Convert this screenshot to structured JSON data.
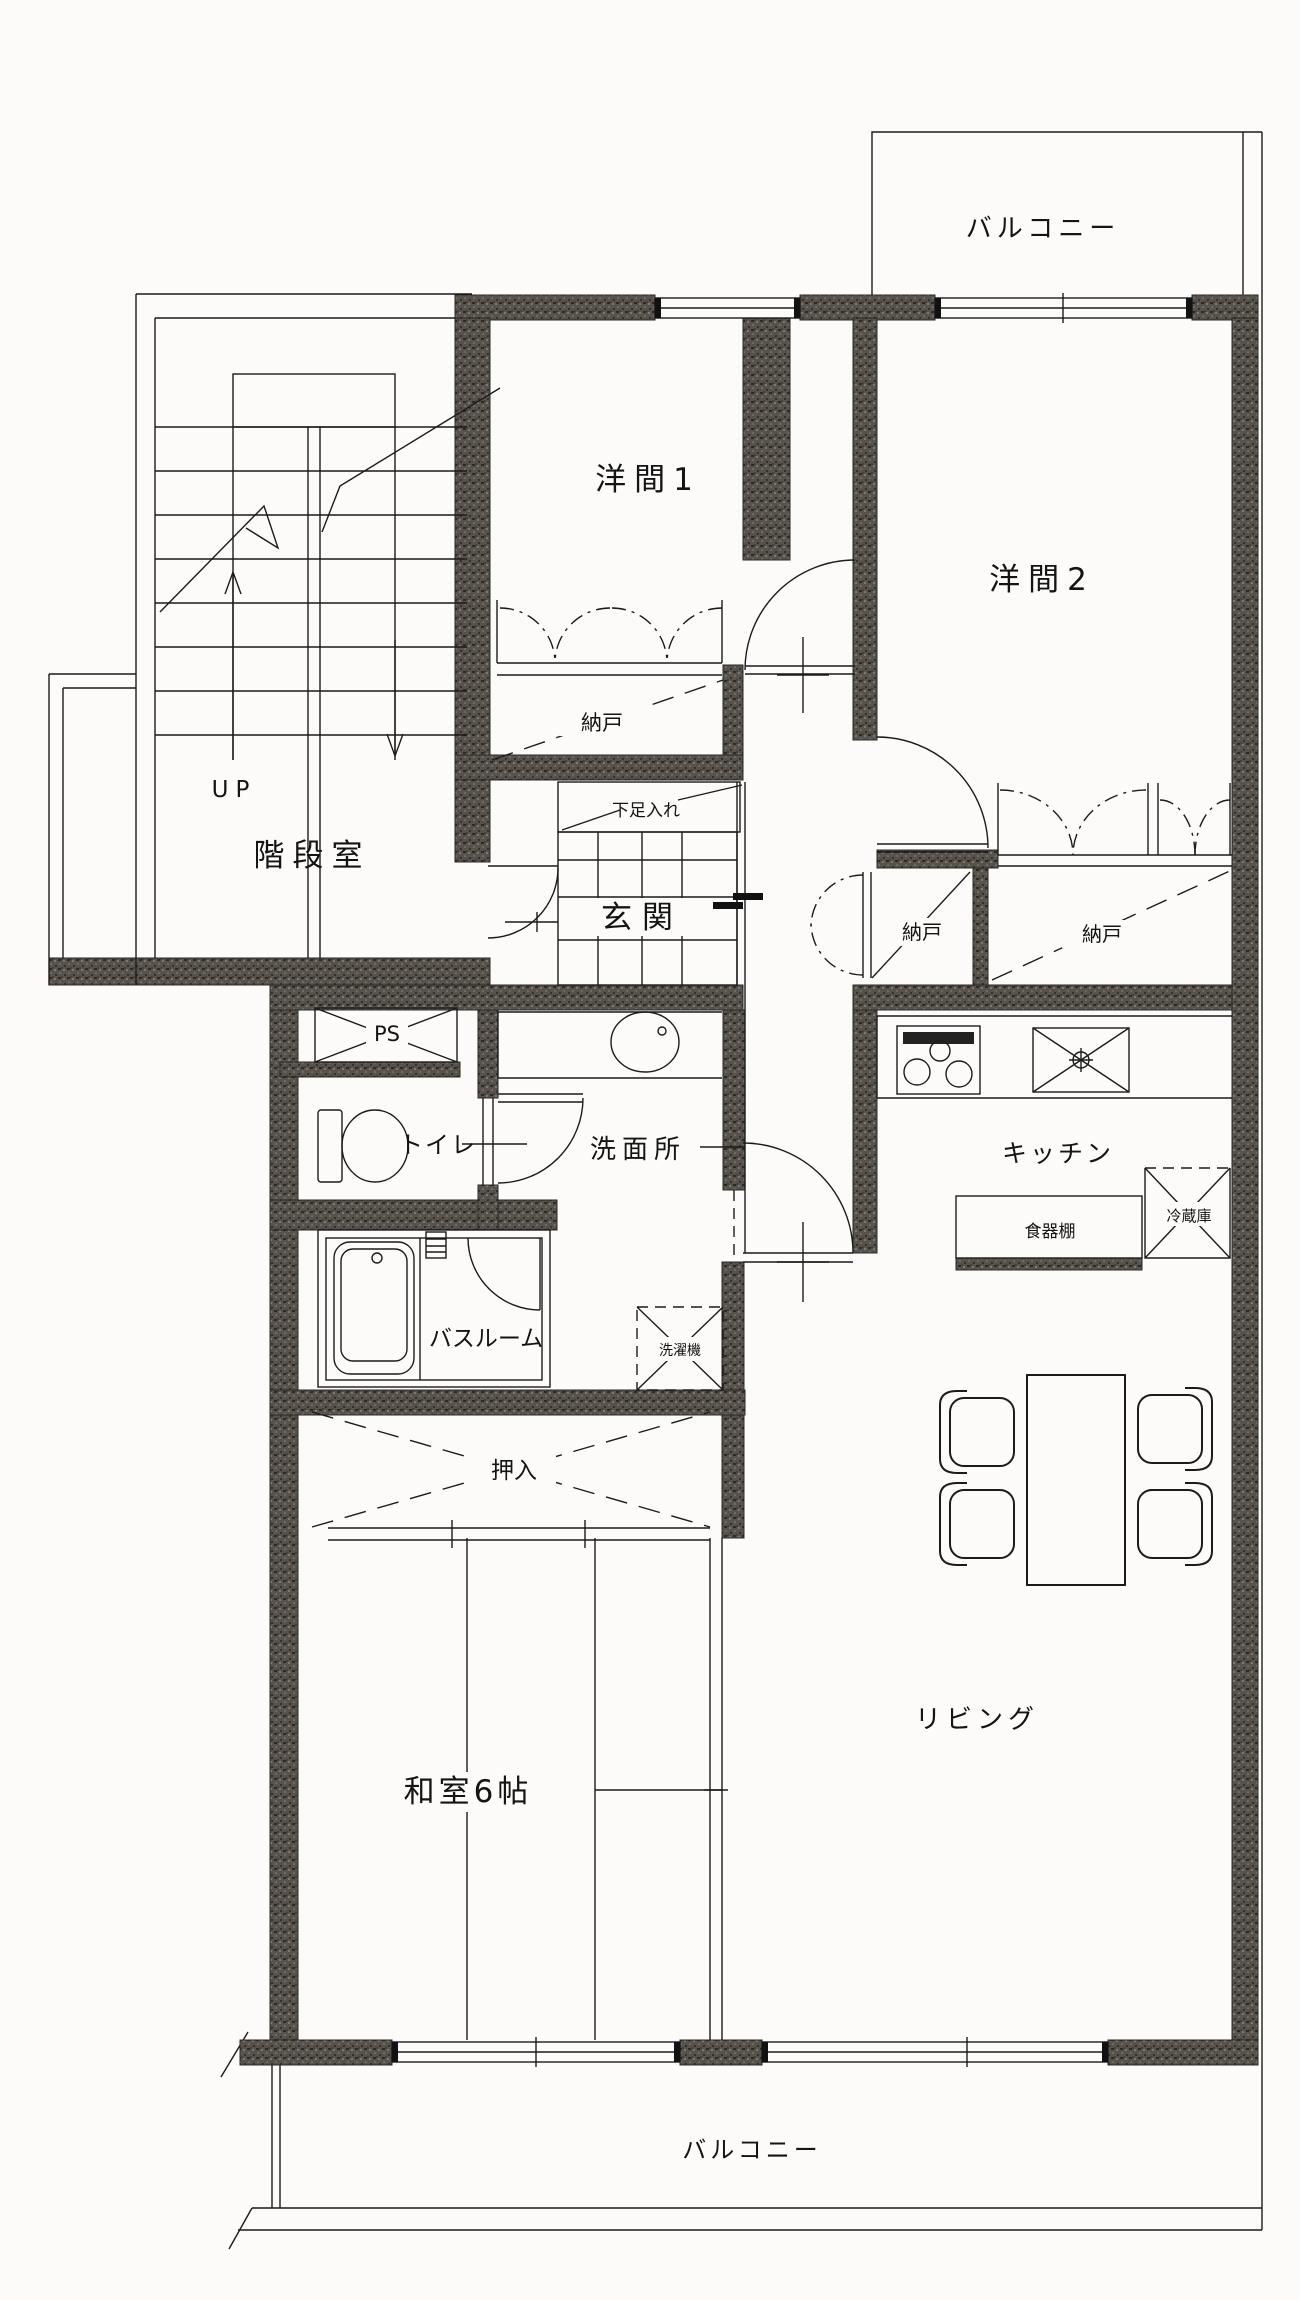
{
  "plan": {
    "type_note": "apartment floor plan",
    "labels": {
      "balcony_top": "バルコニー",
      "western_room_1": "洋間1",
      "western_room_2": "洋間2",
      "storage_1": "納戸",
      "storage_2": "納戸",
      "storage_3": "納戸",
      "shoe_cabinet": "下足入れ",
      "entrance": "玄関",
      "stair_room": "階段室",
      "up": "UP",
      "pipe_space": "PS",
      "toilet": "トイレ",
      "washroom": "洗面所",
      "kitchen": "キッチン",
      "cupboard": "食器棚",
      "refrigerator": "冷蔵庫",
      "bathroom": "バスルーム",
      "washing_machine": "洗濯機",
      "closet": "押入",
      "japanese_room": "和室6帖",
      "living": "リビング",
      "balcony_bottom": "バルコニー"
    },
    "colors": {
      "wall": "#57534c",
      "line": "#1b1b1b",
      "background": "#fcfbf9"
    }
  }
}
